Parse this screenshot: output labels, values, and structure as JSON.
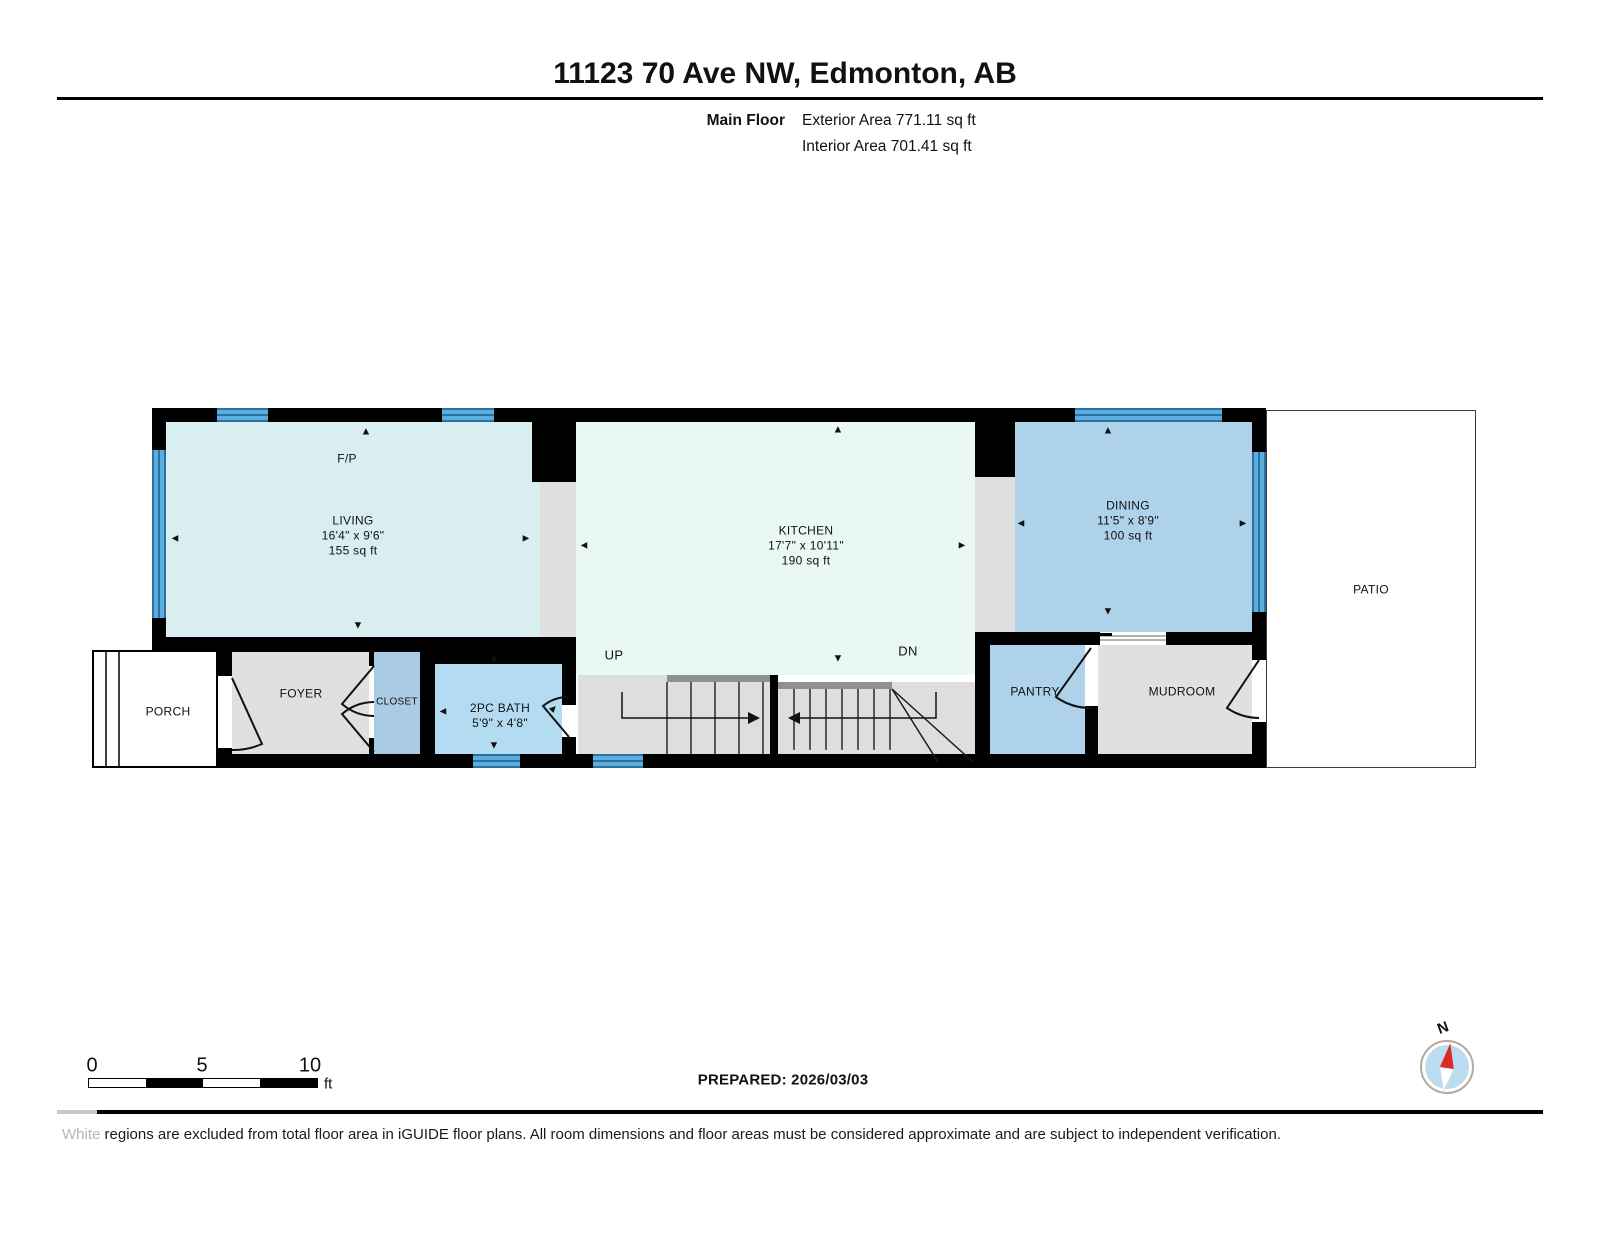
{
  "header": {
    "title": "11123 70 Ave NW, Edmonton, AB",
    "floor_label": "Main Floor",
    "exterior_area": "Exterior Area 771.11 sq ft",
    "interior_area": "Interior Area 701.41 sq ft"
  },
  "plan": {
    "fireplace_label": "F/P",
    "stair_up_label": "UP",
    "stair_down_label": "DN",
    "rooms": {
      "living": {
        "name": "LIVING",
        "dims": "16'4\" x 9'6\"",
        "area": "155 sq ft"
      },
      "kitchen": {
        "name": "KITCHEN",
        "dims": "17'7\" x 10'11\"",
        "area": "190 sq ft"
      },
      "dining": {
        "name": "DINING",
        "dims": "11'5\" x 8'9\"",
        "area": "100 sq ft"
      },
      "bath": {
        "name": "2PC BATH",
        "dims": "5'9\" x 4'8\""
      },
      "closet": {
        "name": "CLOSET"
      },
      "foyer": {
        "name": "FOYER"
      },
      "porch": {
        "name": "PORCH"
      },
      "pantry": {
        "name": "PANTRY"
      },
      "mudroom": {
        "name": "MUDROOM"
      },
      "patio": {
        "name": "PATIO"
      }
    }
  },
  "icons": {
    "arrow_up": "▲",
    "arrow_down": "▼",
    "arrow_left": "◄",
    "arrow_right": "►"
  },
  "scale_bar": {
    "tick_0": "0",
    "tick_5": "5",
    "tick_10": "10",
    "unit": "ft"
  },
  "prepared_label": "PREPARED: 2026/03/03",
  "compass": {
    "north_label": "N"
  },
  "footer": {
    "lead_word": "White",
    "text": " regions are excluded from total floor area in iGUIDE floor plans. All room dimensions and floor areas must be considered approximate and are subject to independent verification."
  },
  "colors": {
    "room_cyan": "#d9eef0",
    "room_mint": "#e9f8f4",
    "room_blue": "#aed2e9",
    "room_bath": "#b3dcf3",
    "room_closet": "#a9cbe3",
    "hall_gray": "#e0e0e0",
    "stair_gray": "#dedede",
    "wall_black": "#000000",
    "window_blue": "#5baddd",
    "window_dark": "#2a729f",
    "compass_red": "#d92b27",
    "compass_blue": "#bcdcf2"
  }
}
